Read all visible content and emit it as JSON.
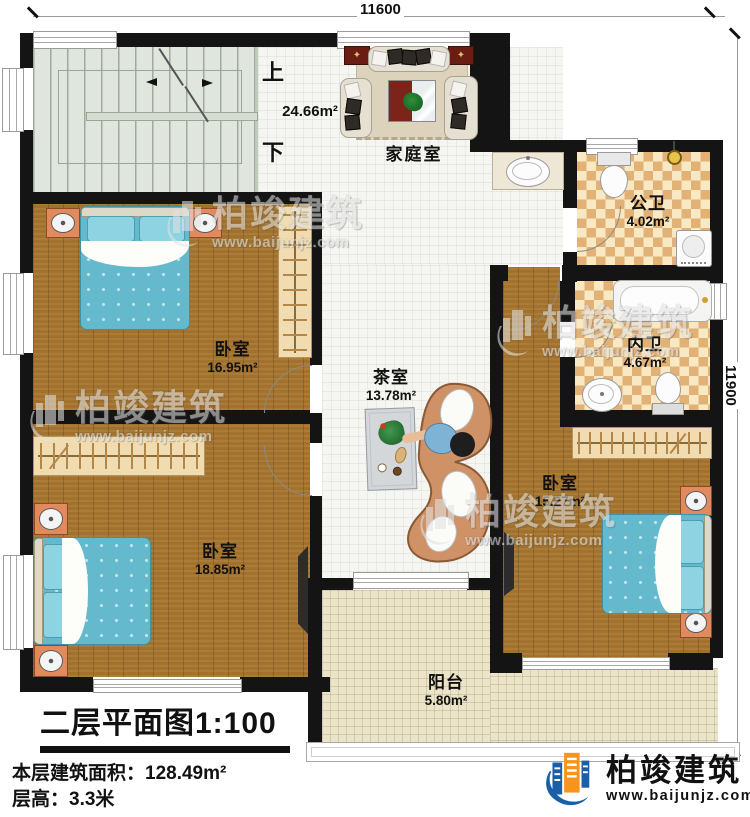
{
  "dimensions": {
    "top": "11600",
    "right": "11900"
  },
  "rooms": {
    "family_room": {
      "name": "家庭室",
      "area": "24.66m²"
    },
    "stairs": {
      "up": "上",
      "down": "下"
    },
    "public_bathroom": {
      "name": "公卫",
      "area": "4.02m²"
    },
    "private_bathroom": {
      "name": "内卫",
      "area": "4.67m²"
    },
    "bedroom_left": {
      "name": "卧室",
      "area": "16.95m²"
    },
    "tea_room": {
      "name": "茶室",
      "area": "13.78m²"
    },
    "bedroom_right": {
      "name": "卧室",
      "area": "15.27m²"
    },
    "bedroom_bottom": {
      "name": "卧室",
      "area": "18.85m²"
    },
    "balcony": {
      "name": "阳台",
      "area": "5.80m²"
    }
  },
  "title_block": {
    "title": "二层平面图1:100",
    "area_label": "本层建筑面积：",
    "area_value": "128.49m²",
    "floor_height_label": "层高：",
    "floor_height_value": "3.3米"
  },
  "brand": {
    "name": "柏竣建筑",
    "website": "www.baijunjz.com"
  },
  "watermark": {
    "name": "柏竣建筑",
    "website": "www.baijunjz.com"
  },
  "colors": {
    "wall": "#141414",
    "wood_floor": "#a6752e",
    "tile_floor": "#f5f5f2",
    "bath_tile_light": "#f8e9c4",
    "bath_tile_dark": "#e2b175",
    "stair_floor": "#e0e6dd",
    "balcony_floor": "#ece4c8",
    "bed_blue": "#64b9cd",
    "brand_blue": "#1660a8",
    "brand_orange": "#f7941d"
  }
}
